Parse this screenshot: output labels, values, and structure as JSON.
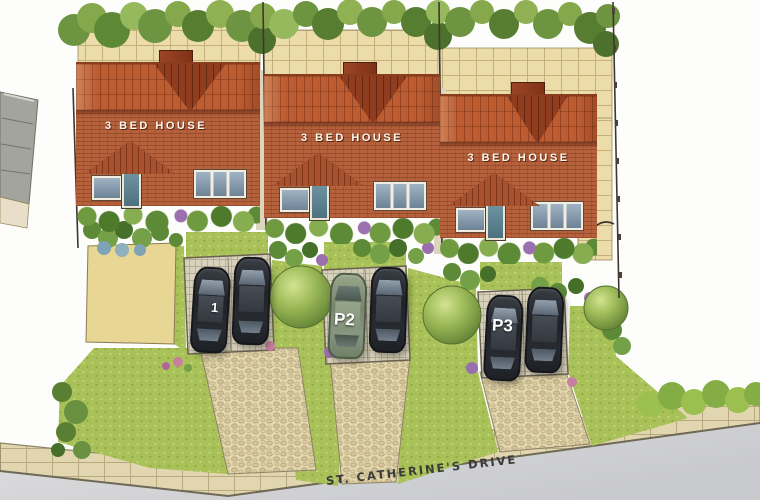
{
  "houses": [
    {
      "label": "3 BED HOUSE"
    },
    {
      "label": "3 BED HOUSE"
    },
    {
      "label": "3 BED HOUSE"
    }
  ],
  "parking_spaces": [
    {
      "label": "1"
    },
    {
      "label": "P2"
    },
    {
      "label": "P3"
    }
  ],
  "street": {
    "name": "ST. CATHERINE'S DRIVE"
  },
  "palette": {
    "roof_tile": "#bd5c31",
    "roof_gable": "#8f3d1e",
    "brick_wall": "#b4613c",
    "patio_paving": "#ecdcaa",
    "lawn": "#a9c159",
    "hedge": "#6d9440",
    "cobble_path": "#e4d7ac",
    "parking_paving": "#d8d1bc",
    "car_dark": "#23262b",
    "car_green": "#81906f",
    "road": "#d3d4d7",
    "sidewalk": "#e1d6af"
  }
}
